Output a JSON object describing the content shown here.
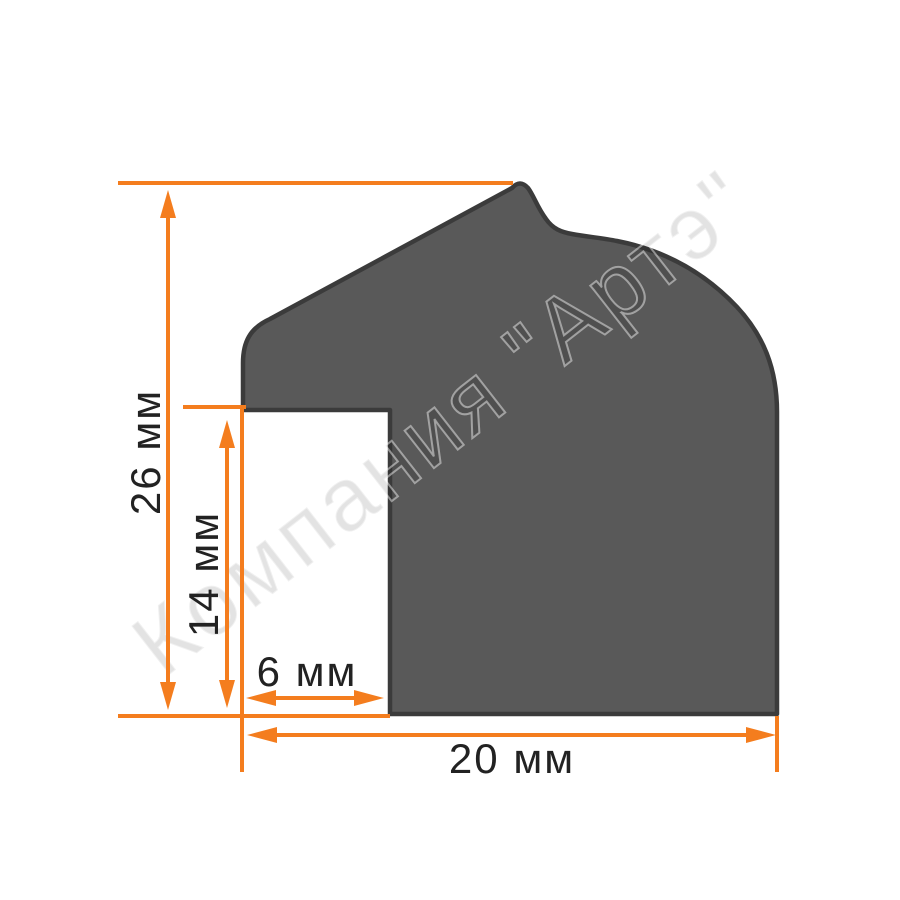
{
  "title": "Frame moulding profile cross-section drawing",
  "watermark": "Компания \"Артэ\"",
  "dimensions": {
    "total_height": {
      "label": "26 мм",
      "value": 26,
      "unit": "мм"
    },
    "rebate_height": {
      "label": "14 мм",
      "value": 14,
      "unit": "мм"
    },
    "rebate_width": {
      "label": "6 мм",
      "value": 6,
      "unit": "мм"
    },
    "total_width": {
      "label": "20 мм",
      "value": 20,
      "unit": "мм"
    }
  },
  "colors": {
    "accent": "#F47D1E",
    "profile_fill": "#595959",
    "profile_stroke": "#3B3B3B",
    "label_text": "#222222",
    "background": "#FFFFFF"
  }
}
